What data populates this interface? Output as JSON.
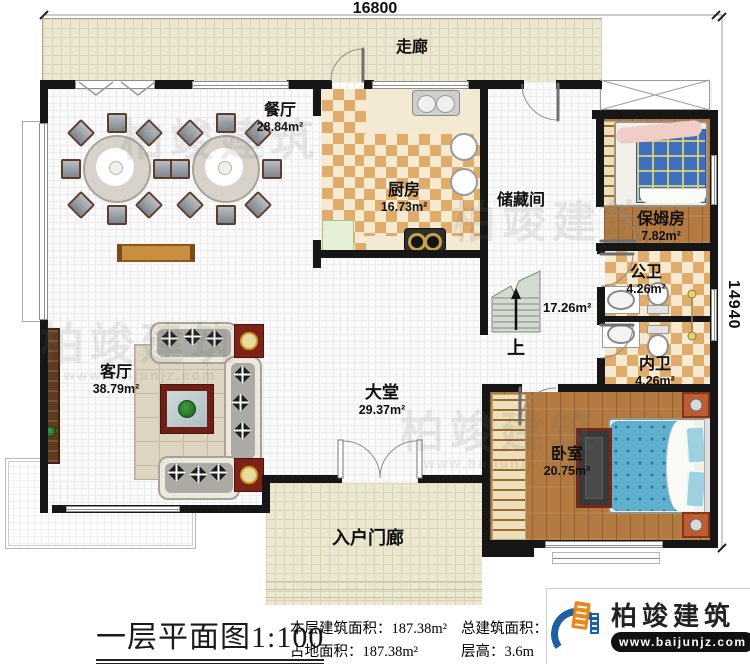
{
  "plan": {
    "dim_width": "16800",
    "dim_height": "14940",
    "rooms": [
      {
        "id": "corridor",
        "name": "走廊",
        "area": ""
      },
      {
        "id": "dining",
        "name": "餐厅",
        "area": "28.84m²"
      },
      {
        "id": "kitchen",
        "name": "厨房",
        "area": "16.73m²"
      },
      {
        "id": "storage",
        "name": "储藏间",
        "area": ""
      },
      {
        "id": "nanny",
        "name": "保姆房",
        "area": "7.82m²"
      },
      {
        "id": "public-bath",
        "name": "公卫",
        "area": "4.26m²"
      },
      {
        "id": "private-bath",
        "name": "内卫",
        "area": "4.26m²"
      },
      {
        "id": "stair-hall",
        "name": "",
        "area": "17.26m²"
      },
      {
        "id": "lobby",
        "name": "大堂",
        "area": "29.37m²"
      },
      {
        "id": "living",
        "name": "客厅",
        "area": "38.79m²"
      },
      {
        "id": "bedroom",
        "name": "卧室",
        "area": "20.75m²"
      },
      {
        "id": "porch",
        "name": "入户门廊",
        "area": ""
      }
    ],
    "stair_up": "上"
  },
  "footer": {
    "title": "一层平面图",
    "scale": "1:100",
    "stats": [
      {
        "label": "本层建筑面积：",
        "value": "187.38m²"
      },
      {
        "label": "总建筑面积：",
        "value": "370.19m²"
      },
      {
        "label": "占地面积：",
        "value": "187.38m²"
      },
      {
        "label": "层高：",
        "value": "3.6m"
      }
    ]
  },
  "brand": {
    "name": "柏竣建筑",
    "url": "www.baijunjz.com"
  },
  "watermark": {
    "text": "柏竣建筑",
    "sub": "www.baijunjz.com"
  },
  "colors": {
    "wall": "#161616",
    "checker": "#e0ac6c",
    "wood": "#b27a40",
    "corridor_floor": "#ebe7d1",
    "bed_plaid": "#3f6fbe",
    "duvet": "#5fb0cf",
    "brand_blue": "#1d5fa5",
    "brand_orange": "#e8891d"
  }
}
